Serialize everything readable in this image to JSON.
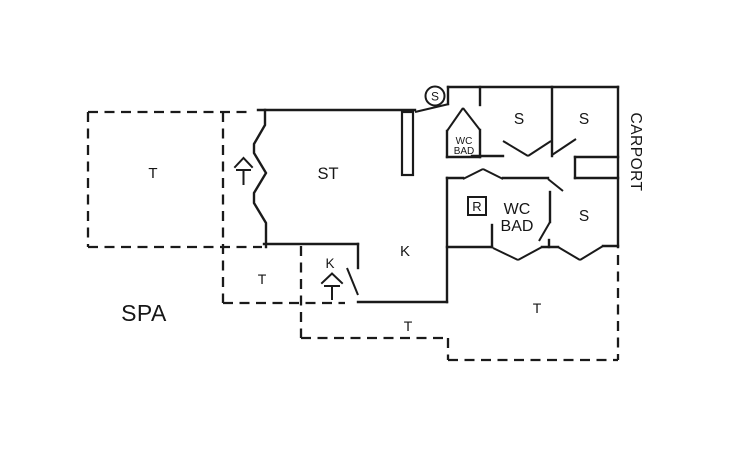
{
  "plan": {
    "type": "holiday-house-floor-plan",
    "colors": {
      "ink": "#1a1a1a",
      "background": "#ffffff"
    },
    "labels": [
      {
        "id": "terrace-west",
        "text": "T"
      },
      {
        "id": "living-room",
        "text": "ST"
      },
      {
        "id": "bedroom-1",
        "text": "S"
      },
      {
        "id": "bedroom-2",
        "text": "S"
      },
      {
        "id": "carport",
        "text": "CARPORT"
      },
      {
        "id": "wc-bath-1-line1",
        "text": "WC"
      },
      {
        "id": "wc-bath-1-line2",
        "text": "BAD"
      },
      {
        "id": "wc-bath-2-line1",
        "text": "WC"
      },
      {
        "id": "wc-bath-2-line2",
        "text": "BAD"
      },
      {
        "id": "bedroom-3",
        "text": "S"
      },
      {
        "id": "kitchen",
        "text": "K"
      },
      {
        "id": "kitchen-door",
        "text": "K"
      },
      {
        "id": "terrace-small",
        "text": "T"
      },
      {
        "id": "spa",
        "text": "SPA"
      },
      {
        "id": "terrace-south-mid",
        "text": "T"
      },
      {
        "id": "terrace-south-east",
        "text": "T"
      }
    ],
    "symbols": {
      "entrance_circle_letter": "S",
      "r_box_letter": "R"
    }
  }
}
